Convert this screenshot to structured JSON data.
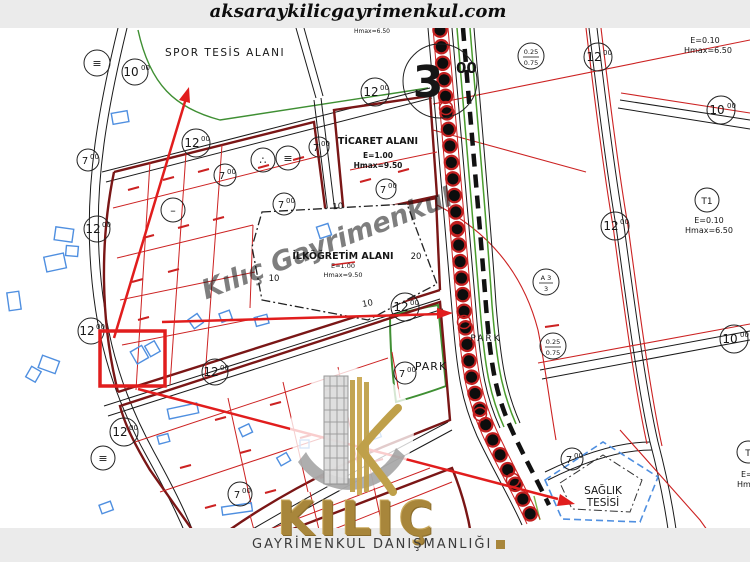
{
  "header": {
    "website": "aksaraykilicgayrimenkul.com"
  },
  "footer": {
    "brand": "KILIÇ",
    "tagline": "GAYRİMENKUL DANIŞMANLIĞI"
  },
  "watermarks": {
    "diagonal": "Kılıç Gayrimenkul"
  },
  "colors": {
    "bar_background": "#ebebeb",
    "parcel_red": "#cc2222",
    "block_maroon": "#7a1616",
    "building_blue": "#4f8fe0",
    "park_green": "#4a9c2d",
    "annotation_red": "#e11d1d",
    "logo_gold": "#a8863b",
    "road_black": "#1a1a1a"
  },
  "map": {
    "zones": {
      "spor": {
        "label": "SPOR TESİS ALANI"
      },
      "ticaret": {
        "label": "TİCARET ALANI",
        "e": "E=1.00",
        "hmax": "Hmax=9.50"
      },
      "ilkogretim": {
        "label": "İLKÖĞRETİM ALANI",
        "e": "E=1.00",
        "hmax": "Hmax=9.50"
      },
      "park_strip": {
        "label": "PARK"
      },
      "park_main": {
        "label": "PARK"
      },
      "saglik": {
        "line1": "SAĞLIK",
        "line2": "TESİSİ"
      },
      "zone_topright": {
        "e": "E=0.10",
        "hmax": "Hmax=6.50"
      },
      "zone_top_partial": {
        "hmax": "Hmax=6.50"
      },
      "t1": {
        "code": "T1",
        "e": "E=0.10",
        "hmax": "Hmax=6.50"
      },
      "t1_partial": {
        "code": "T",
        "e": "E=",
        "hmax": "Hma"
      }
    },
    "junction": {
      "main": "3",
      "sup": "00"
    },
    "road_width_labels": {
      "w12": {
        "main": "12",
        "sup": "00"
      },
      "w10": {
        "main": "10",
        "sup": "00"
      },
      "w7": {
        "main": "7",
        "sup": "00"
      }
    },
    "symbols": [
      "≡",
      "≡",
      "–",
      "∴",
      "≡"
    ],
    "density": {
      "taks_kaks": {
        "top": "0.25",
        "bottom": "0.75"
      },
      "order": {
        "top": "A 3",
        "bottom": "3"
      }
    },
    "dims": {
      "d10": "10",
      "d20": "20"
    }
  }
}
